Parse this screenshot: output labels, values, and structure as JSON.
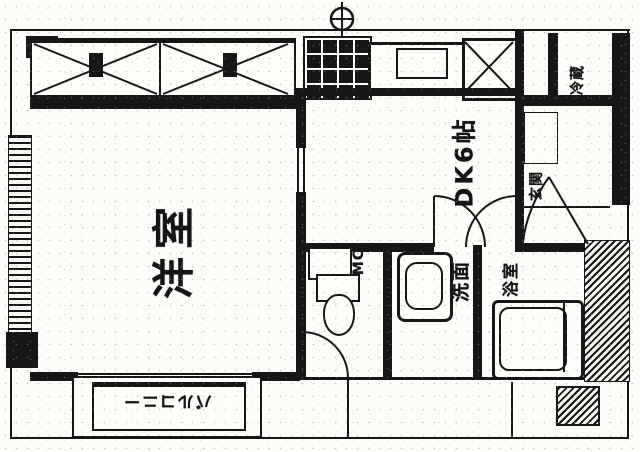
{
  "document": {
    "kind": "scanned apartment floor plan (black-and-white)"
  },
  "colors": {
    "ink": "#161616",
    "paper": "#fcfcf9"
  },
  "labels": {
    "living_room": "洋室",
    "dining_kitchen": "DK6帖",
    "meter_closet": "MC",
    "washroom": "洗面",
    "bathroom": "浴室",
    "entrance": "玄関",
    "refrigerator": "冷蔵",
    "balcony": "バルコニー"
  },
  "symbols": {
    "gas_meter": "circle-with-cross meter at top",
    "x_brace": "cross-braced void boxes along top",
    "door_swings": "quarter-circle door arcs",
    "fixtures": [
      "kitchen-grid-unit",
      "sink-counter",
      "toilet",
      "wash-stand",
      "bathtub"
    ]
  }
}
